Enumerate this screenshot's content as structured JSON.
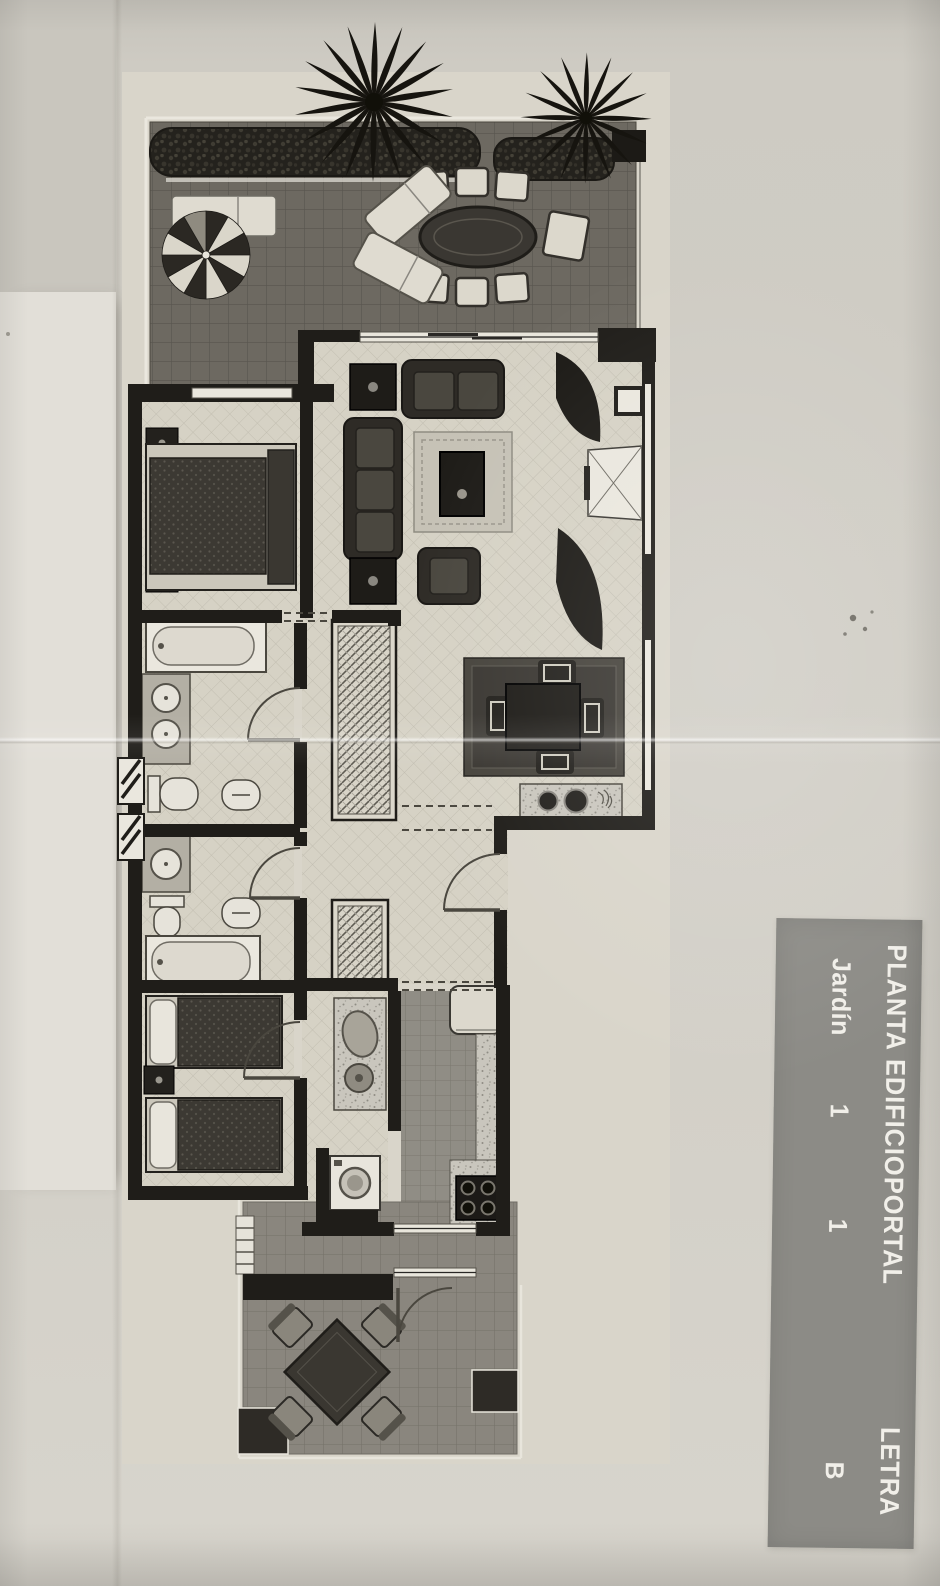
{
  "title_block": {
    "columns": [
      {
        "header": "PLANTA",
        "value": "Jardín"
      },
      {
        "header": "EDIFICIO",
        "value": "1"
      },
      {
        "header": "PORTAL",
        "value": "1"
      },
      {
        "header": "LETRA",
        "value": "B"
      }
    ]
  },
  "palette": {
    "paper": "#cfccc4",
    "plan_sheet": "#d9d5ca",
    "wall": "#1f1d19",
    "terrace_tile": "#6d6961",
    "interior_tile": "#d6d2c5",
    "kitchen_tile": "#908d85",
    "lower_terrace_tile": "#8a867e",
    "label_bg": "#8c8b86",
    "label_text": "#f1efe9"
  }
}
